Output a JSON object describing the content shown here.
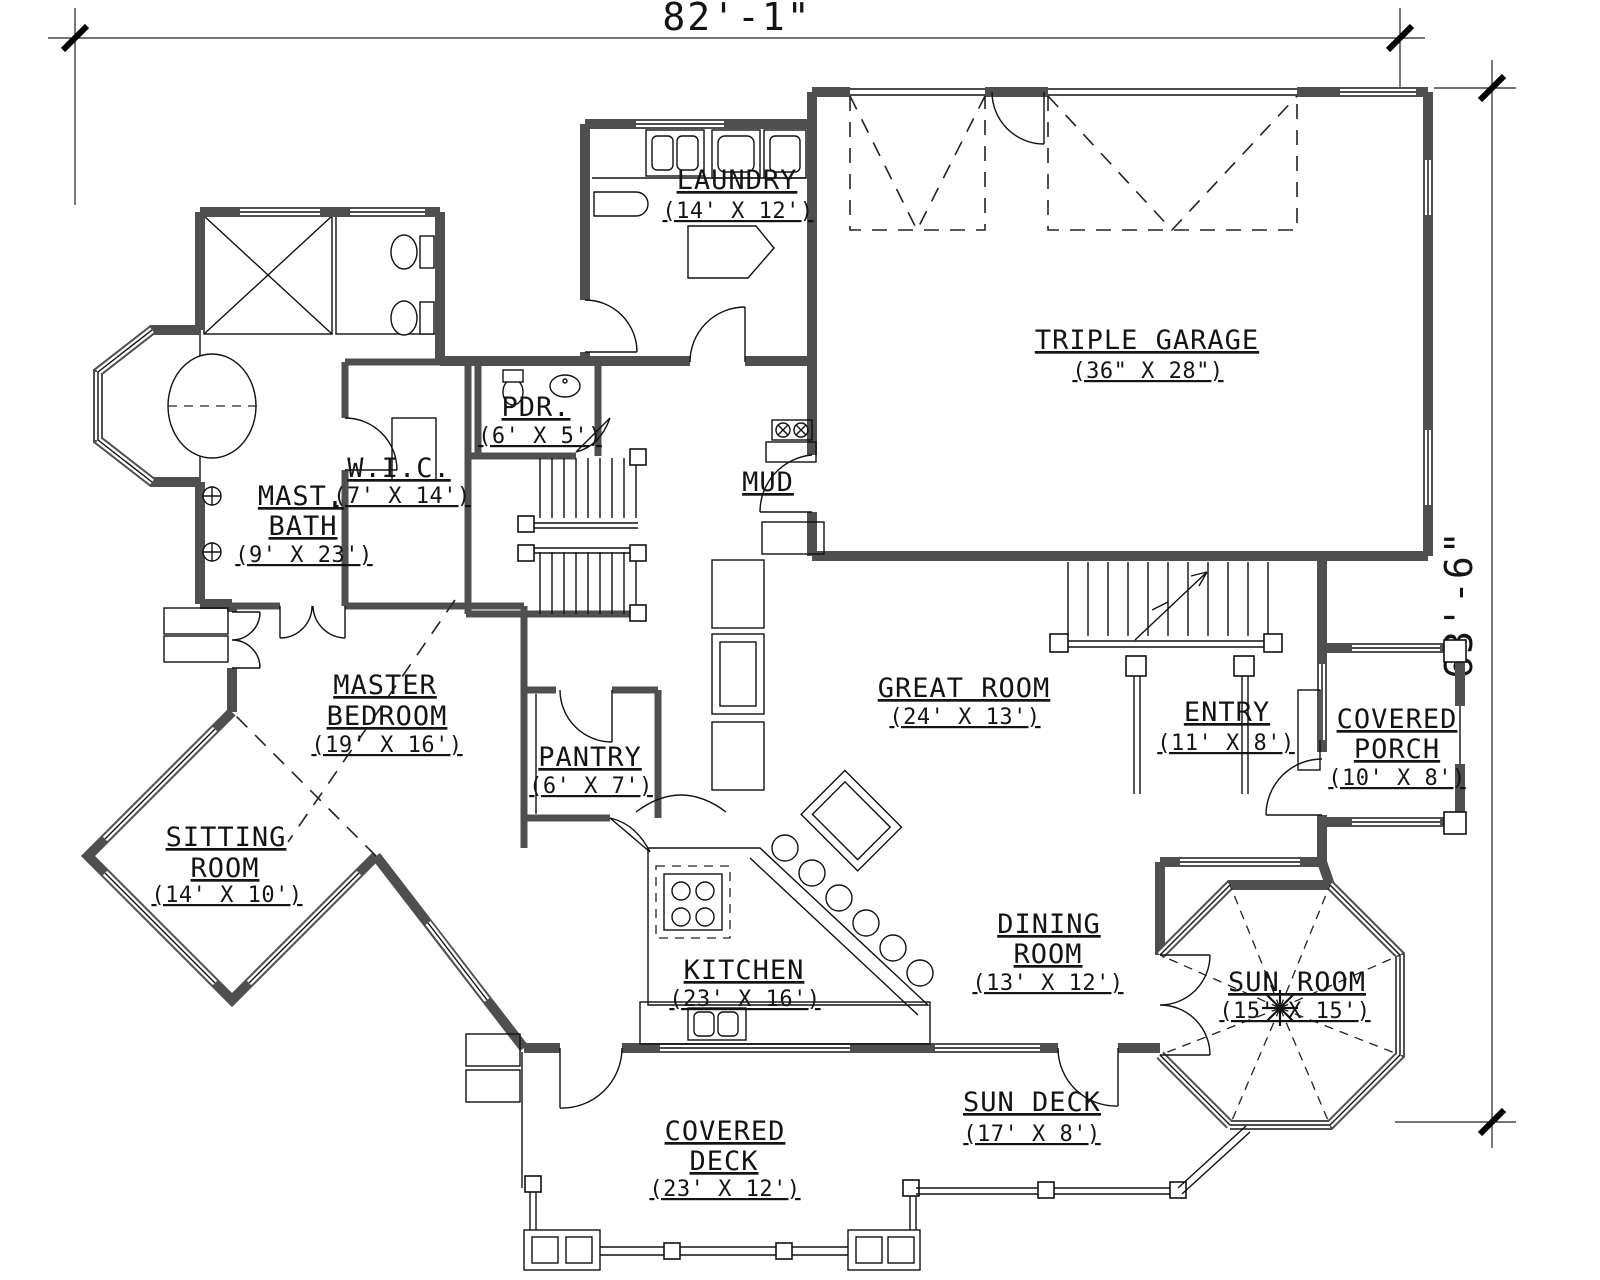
{
  "meta": {
    "drawing_type": "house-first-floor-plan",
    "background_color": "#ffffff",
    "line_color": "#000000",
    "wall_color": "#4f4f4f"
  },
  "dimensions": {
    "overall_width": "82'-1\"",
    "overall_height": "63'-6\""
  },
  "rooms": {
    "laundry": {
      "name": "LAUNDRY",
      "dims": "(14' X 12')"
    },
    "garage": {
      "name": "TRIPLE GARAGE",
      "dims": "(36\" X 28\")"
    },
    "mast_bath": {
      "line1": "MAST.",
      "line2": "BATH",
      "dims": "(9' X 23')"
    },
    "wic": {
      "name": "W.I.C.",
      "dims": "(7' X 14')"
    },
    "pdr": {
      "name": "PDR.",
      "dims": "(6' X 5')"
    },
    "mud": {
      "name": "MUD"
    },
    "master_bedroom": {
      "line1": "MASTER",
      "line2": "BEDROOM",
      "dims": "(19' X 16')"
    },
    "sitting_room": {
      "line1": "SITTING",
      "line2": "ROOM",
      "dims": "(14' X 10')"
    },
    "pantry": {
      "name": "PANTRY",
      "dims": "(6' X 7')"
    },
    "kitchen": {
      "name": "KITCHEN",
      "dims": "(23' X 16')"
    },
    "great_room": {
      "name": "GREAT ROOM",
      "dims": "(24' X 13')"
    },
    "entry": {
      "name": "ENTRY",
      "dims": "(11' X 8')"
    },
    "covered_porch": {
      "line1": "COVERED",
      "line2": "PORCH",
      "dims": "(10' X 8')"
    },
    "dining_room": {
      "line1": "DINING",
      "line2": "ROOM",
      "dims": "(13' X 12')"
    },
    "sun_room": {
      "name": "SUN ROOM",
      "dims": "(15' X 15')"
    },
    "sun_deck": {
      "name": "SUN DECK",
      "dims": "(17' X 8')"
    },
    "covered_deck": {
      "line1": "COVERED",
      "line2": "DECK",
      "dims": "(23' X 12')"
    }
  }
}
